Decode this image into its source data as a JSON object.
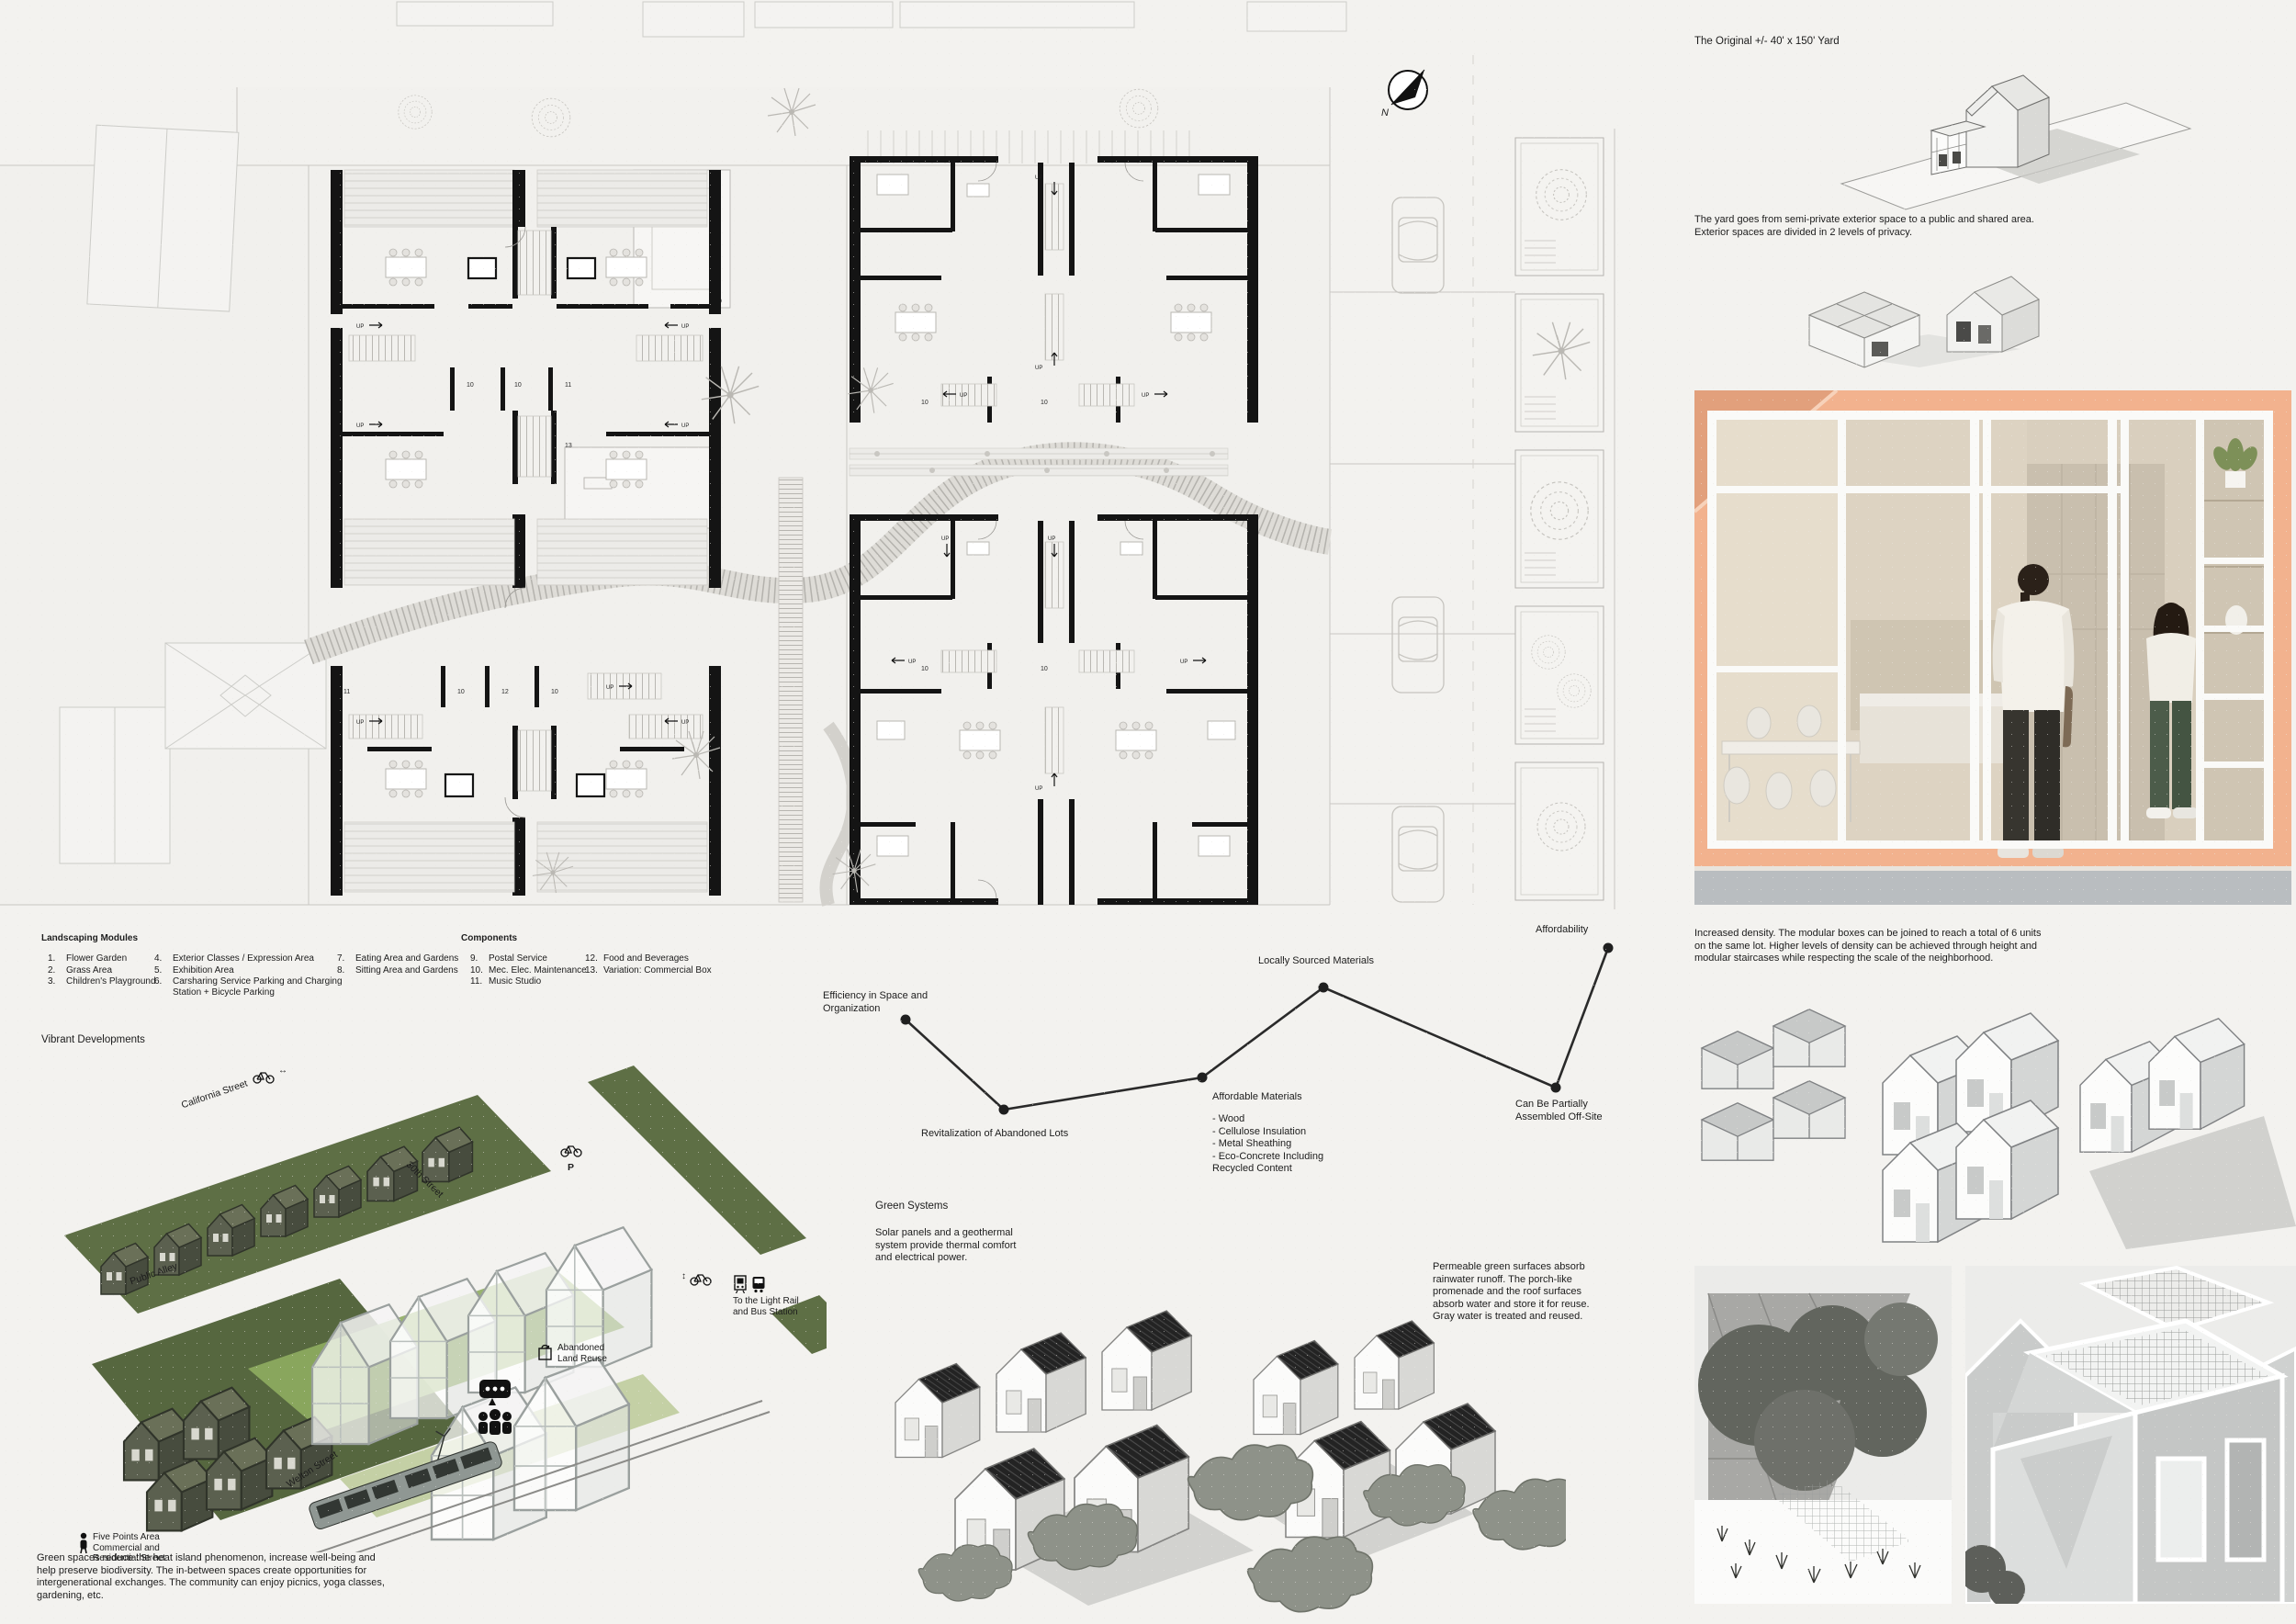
{
  "colors": {
    "background": "#f3f2ef",
    "ink": "#1c1c1c",
    "plan_wall": "#141414",
    "olive_green": "#5e6f45",
    "promenade_green": "#8fad60",
    "peach": "#f2b28e",
    "interior_beige": "#d9cfbe",
    "floor_gray": "#b9bdc0",
    "render_gray": "#d6d6d4",
    "roof_black": "#1e1e1e"
  },
  "plan": {
    "north_label": "N",
    "up_label": "UP",
    "numbers": {
      "n9": "9",
      "n10": "10",
      "n11": "11",
      "n12": "12",
      "n13": "13"
    }
  },
  "yard_study": {
    "title": "The Original +/- 40' x 150' Yard",
    "caption": "The yard goes from semi-private exterior space to a public and shared area.\nExterior spaces are divided in 2 levels of privacy."
  },
  "legend": {
    "landscaping_title": "Landscaping Modules",
    "landscaping": [
      {
        "num": "1.",
        "label": "Flower Garden"
      },
      {
        "num": "2.",
        "label": "Grass Area"
      },
      {
        "num": "3.",
        "label": "Children's Playground"
      },
      {
        "num": "4.",
        "label": "Exterior Classes / Expression Area"
      },
      {
        "num": "5.",
        "label": "Exhibition Area"
      },
      {
        "num": "6.",
        "label": "Carsharing Service Parking and Charging\nStation + Bicycle Parking"
      },
      {
        "num": "7.",
        "label": "Eating Area and Gardens"
      },
      {
        "num": "8.",
        "label": "Sitting Area and Gardens"
      }
    ],
    "components_title": "Components",
    "components": [
      {
        "num": "9.",
        "label": "Postal Service"
      },
      {
        "num": "10.",
        "label": "Mec. Elec. Maintenance"
      },
      {
        "num": "11.",
        "label": "Music Studio"
      },
      {
        "num": "12.",
        "label": "Food and Beverages"
      },
      {
        "num": "13.",
        "label": "Variation: Commercial Box"
      }
    ]
  },
  "vibrant": {
    "title": "Vibrant Developments",
    "streets": {
      "california": "California Street",
      "thirtieth": "30th Street",
      "public_alley": "Public Alley",
      "welton": "Welton Street"
    },
    "labels": {
      "five_points": "Five Points Area\nCommercial and\nResidential Street",
      "abandoned": "Abandoned\nLand Reuse",
      "light_rail": "To the Light Rail\nand Bus Station",
      "parking": "P",
      "arrow_lr": "↔",
      "arrow_ud": "↕"
    },
    "paragraph": "Green spaces reduce the heat island phenomenon, increase well-being and\nhelp preserve biodiversity. The in-between spaces create opportunities for\nintergenerational exchanges. The community can enjoy picnics, yoga classes,\ngardening, etc."
  },
  "concept_chart": {
    "labels": {
      "efficiency": "Efficiency in Space and\nOrganization",
      "revitalization": "Revitalization of Abandoned Lots",
      "affordable_materials": "Affordable Materials",
      "materials_list": "- Wood\n- Cellulose Insulation\n- Metal Sheathing\n- Eco-Concrete Including\n  Recycled Content",
      "locally_sourced": "Locally Sourced Materials",
      "off_site": "Can Be Partially\nAssembled Off-Site",
      "affordability": "Affordability"
    }
  },
  "chart_data": {
    "type": "line",
    "title": "",
    "xlabel": "",
    "ylabel": "",
    "grid": false,
    "legend_position": "none",
    "categories": [
      "Efficiency in Space and Organization",
      "Revitalization of Abandoned Lots",
      "Affordable Materials",
      "Locally Sourced Materials",
      "Can Be Partially Assembled Off-Site",
      "Affordability"
    ],
    "values": [
      62,
      28,
      40,
      72,
      37,
      86
    ],
    "value_scale": "qualitative relative height 0-100 (no numeric axis shown)",
    "annotations": [
      "Affordable Materials: - Wood, - Cellulose Insulation, - Metal Sheathing, - Eco-Concrete Including Recycled Content"
    ]
  },
  "green_systems": {
    "title": "Green Systems",
    "solar": "Solar panels and a geothermal\nsystem provide thermal comfort\nand electrical power.",
    "permeable": "Permeable green surfaces absorb\nrainwater runoff. The porch-like\npromenade and the roof surfaces\nabsorb water and store it for reuse.\nGray water is treated and reused."
  },
  "density": {
    "paragraph": "Increased density. The modular boxes can be joined to reach a total of 6 units\non the same lot. Higher levels of density can be achieved through height and\nmodular staircases while respecting the scale of the neighborhood."
  }
}
